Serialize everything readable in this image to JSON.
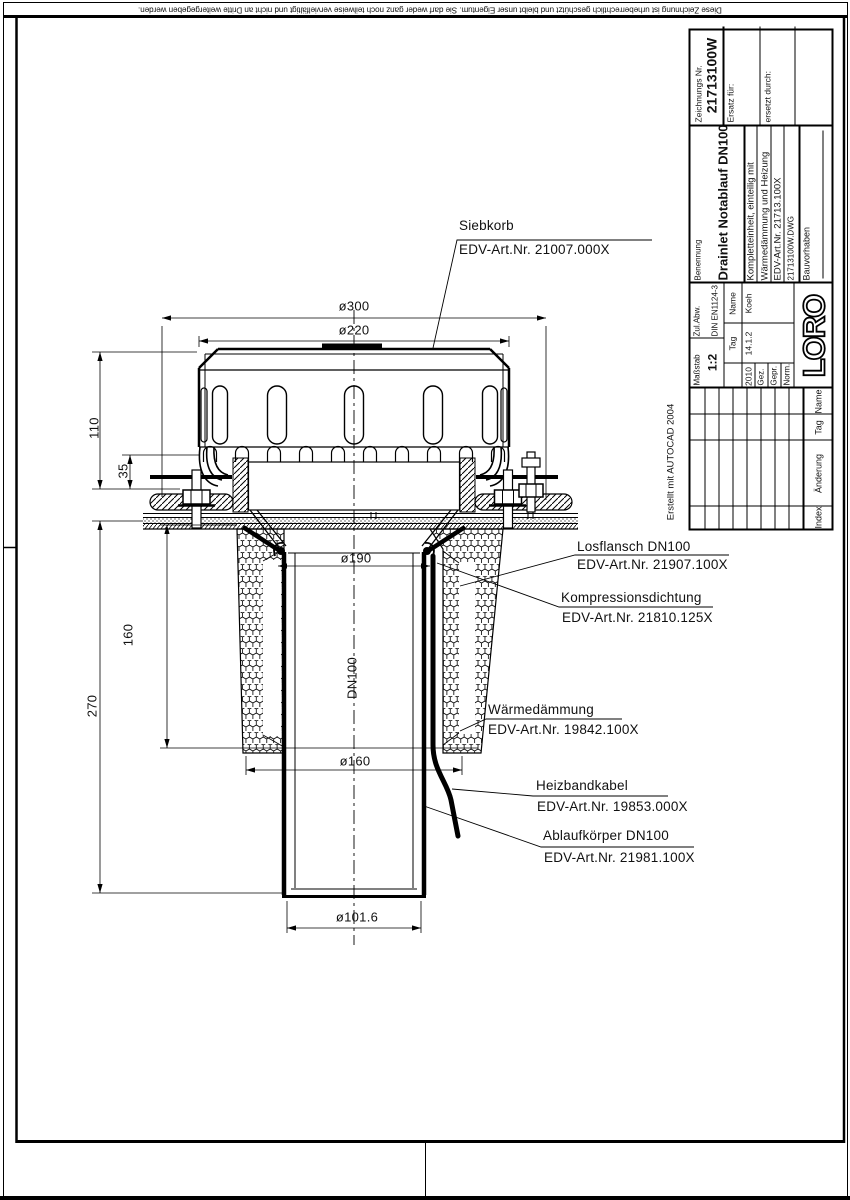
{
  "sheet": {
    "copyright_notice": "Diese Zeichnung ist urheberrechtlich geschützt und bleibt unser Eigentum. Sie darf weder ganz noch teilweise vervielfältigt und nicht an Dritte weitergegeben werden.",
    "created_with": "Erstellt mit AUTOCAD 2004"
  },
  "labels": {
    "siebkorb": {
      "name": "Siebkorb",
      "part_no": "EDV-Art.Nr.  21007.000X"
    },
    "losflansch": {
      "name": "Losflansch  DN100",
      "part_no": "EDV-Art.Nr.  21907.100X"
    },
    "kompressionsdichtung": {
      "name": "Kompressionsdichtung",
      "part_no": "EDV-Art.Nr.  21810.125X"
    },
    "waermedaemmung": {
      "name": "Wärmedämmung",
      "part_no": "EDV-Art.Nr.  19842.100X"
    },
    "heizbandkabel": {
      "name": "Heizbandkabel",
      "part_no": "EDV-Art.Nr.  19853.000X"
    },
    "ablaufkoerper": {
      "name": "Ablaufkörper  DN100",
      "part_no": "EDV-Art.Nr.  21981.100X"
    }
  },
  "dimensions": {
    "d300": "ø300",
    "d220": "ø220",
    "d190": "ø190",
    "d160": "ø160",
    "d101_6": "ø101.6",
    "h110": "110",
    "h35": "35",
    "h160": "160",
    "h270": "270",
    "dn": "DN100"
  },
  "title_block": {
    "zeichnungs_nr_label": "Zeichnungs Nr.",
    "zeichnungs_nr": "21713100W",
    "ersatz_fuer": "Ersatz für:",
    "ersetzt_durch": "ersetzt durch:",
    "benennung_label": "Benennung",
    "benennung": "Drainlet Notablauf DN100",
    "desc1": "Kompletteinheit, einteilig mit",
    "desc2": "Wärmedämmung und Heizung",
    "desc3": "EDV-Art.Nr. 21713.100X",
    "desc4": "21713100W.DWG",
    "bauvorhaben": "Bauvorhaben",
    "massstab_label": "Maßstab",
    "massstab": "1:2",
    "zul_abw_label": "Zul.Abw.",
    "zul_abw": "DIN EN1124-3",
    "tag_label": "Tag",
    "name_label": "Name",
    "year": "2010",
    "date": "14.1.2",
    "drawn_name": "Koeh",
    "gez": "Gez.",
    "gepr": "Gepr.",
    "norm": "Norm.",
    "logo": "LORO",
    "rev_index": "Index",
    "rev_aenderung": "Änderung",
    "rev_tag": "Tag",
    "rev_name": "Name"
  },
  "colors": {
    "ink": "#000000",
    "paper": "#ffffff"
  }
}
